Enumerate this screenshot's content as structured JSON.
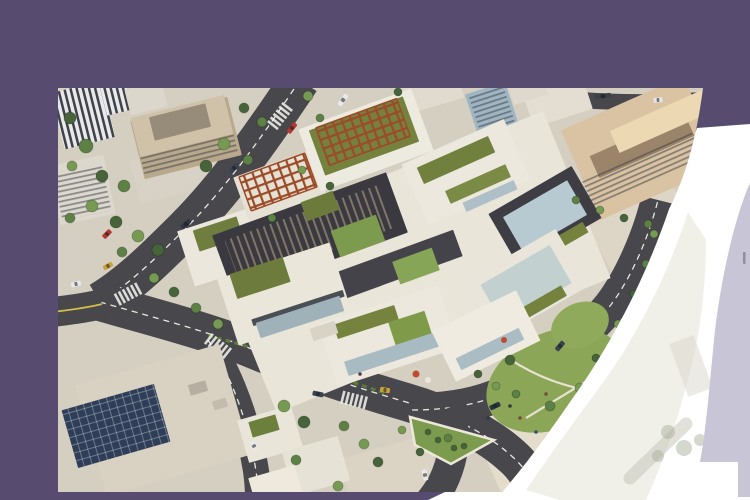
{
  "meta": {
    "description": "Hero banner: aerial architectural rendering of a mixed-use development with green roofs, framed by a purple backdrop with a large white curved cutout, a faint ghost band of the image and a lavender arc strip at the right edge",
    "visible_text": []
  },
  "palette": {
    "purple": "#574b70",
    "lavender": "#c8c5d6",
    "white": "#ffffff",
    "ground": "#d5cfc2",
    "asphalt": "#47474c",
    "lane_dash": "#e8e8e0",
    "lane_yellow": "#d2bf4a",
    "complex_white": "#ece8dd",
    "green_roof": "#74823e",
    "lawn": "#8aa656",
    "pergola_rust": "#9c4a28",
    "dark_structure": "#3a393f",
    "glass": "#b7cad2",
    "hotel_tan": "#d9c3a2",
    "solar_navy": "#2f3e58",
    "tree_colors": [
      "#46633a",
      "#5d8045",
      "#769a52"
    ],
    "people_colors": [
      "#2f3a44",
      "#7a4a3a",
      "#36506a",
      "#503a50"
    ]
  },
  "scene": {
    "photo_box": {
      "left": 58,
      "top": 88,
      "width": 647,
      "height": 404
    },
    "patches": [
      [
        "parking-lot-topleft",
        118,
        84,
        84,
        44,
        -14,
        "#d8d2c6"
      ],
      [
        "plaza-right",
        492,
        330,
        150,
        95,
        -24,
        "#e4ddcc"
      ],
      [
        "plaza-upper-right",
        600,
        168,
        95,
        125,
        -30,
        "#ddd6c6"
      ],
      [
        "lot-bottom",
        332,
        386,
        92,
        56,
        -16,
        "#dbd4c5"
      ]
    ],
    "roads": [
      {
        "n": "back-road",
        "d": "M242,-8 C210,40 170,98 128,140 C100,168 72,196 42,214",
        "w": 40,
        "center": "dash"
      },
      {
        "n": "front-road",
        "d": "M42,214 C90,228 150,243 196,262 C250,284 300,300 348,314 C392,327 430,345 458,372 C470,384 476,396 478,408",
        "w": 38,
        "center": "dash"
      },
      {
        "n": "sweep-road",
        "d": "M354,322 C396,322 434,314 462,296 C498,272 528,248 552,218 C572,192 590,152 600,112",
        "w": 34,
        "center": "dash"
      },
      {
        "n": "down-road",
        "d": "M150,252 C170,282 184,320 192,352 C198,380 200,392 200,410",
        "w": 26,
        "center": "dash"
      },
      {
        "n": "yellow-road",
        "d": "M44,216 C28,220 12,222 -6,224",
        "w": 30,
        "center": "yellow"
      },
      {
        "n": "front-road-exit",
        "d": "M390,320 C400,344 396,372 384,396 C378,406 372,414 366,420",
        "w": 30
      },
      {
        "n": "top-right-street",
        "d": "M480,8 C530,14 580,16 646,12",
        "w": 16
      }
    ],
    "greens": [
      {
        "type": "ellipse",
        "n": "lawn-main",
        "cx": 497,
        "cy": 292,
        "rx": 72,
        "ry": 48,
        "rot": -24,
        "f": "#8aa656"
      },
      {
        "type": "ellipse",
        "n": "lawn-upper",
        "cx": 522,
        "cy": 237,
        "rx": 30,
        "ry": 22,
        "rot": -24,
        "f": "#90aa5c"
      },
      {
        "type": "path",
        "n": "lawn-path",
        "d": "M450,270 C480,290 510,300 545,305",
        "s": "#e8e2d2",
        "sw": 2.2
      },
      {
        "type": "path",
        "n": "lawn-path",
        "d": "M468,330 C494,314 518,300 540,286",
        "s": "#e8e2d2",
        "sw": 2.2
      },
      {
        "type": "poly",
        "n": "median-triangle",
        "pts": "352,329 436,352 393,376 357,357",
        "f": "#7d9b4e",
        "s": "#ece7d8",
        "sw": 2.5
      },
      {
        "type": "path",
        "n": "hedge-line",
        "d": "M150,248 C210,262 268,286 330,306",
        "s": "#5d7a3a",
        "sw": 3,
        "dash": "5,4"
      }
    ],
    "crosswalks": [
      [
        222,
        28,
        -52
      ],
      [
        160,
        258,
        38
      ],
      [
        296,
        312,
        14
      ],
      [
        70,
        206,
        -28
      ]
    ],
    "buildings": [
      [
        "striped-tower",
        25,
        27,
        52,
        58,
        -14,
        "url(#zebra)"
      ],
      [
        "striped-tower-small",
        58,
        10,
        26,
        30,
        -14,
        "url(#zebra)"
      ],
      [
        "white-box-top",
        88,
        10,
        38,
        26,
        -14,
        "#dcd7cd"
      ],
      [
        "office-facade",
        128,
        50,
        100,
        60,
        -14,
        "#b9a98c"
      ],
      [
        "office-window-rows",
        130,
        62,
        96,
        28,
        -14,
        "url(#rows)"
      ],
      [
        "office-roof",
        124,
        38,
        96,
        40,
        -14,
        "#cfc2a9"
      ],
      [
        "office-roof-core",
        122,
        34,
        58,
        24,
        -14,
        "#978b7a"
      ],
      [
        "slab-left",
        24,
        102,
        56,
        60,
        -12,
        "#ddd8ce"
      ],
      [
        "slab-left-rows",
        24,
        104,
        50,
        48,
        -12,
        "url(#rows)"
      ],
      [
        "low-block-left",
        14,
        162,
        40,
        42,
        -12,
        "#d5cfc3"
      ],
      [
        "solar-roof-building",
        105,
        332,
        150,
        115,
        -16,
        "#d9d1c1"
      ],
      [
        "solar-panels",
        58,
        338,
        96,
        60,
        -16,
        "#2f3e58"
      ],
      [
        "solar-panel-grid",
        58,
        338,
        96,
        60,
        -16,
        "url(#grid)"
      ],
      [
        "rooftop-unit",
        140,
        300,
        18,
        11,
        -16,
        "#b5aea1"
      ],
      [
        "rooftop-unit",
        162,
        316,
        14,
        9,
        -16,
        "#c2bbae"
      ],
      [
        "res-block",
        212,
        346,
        56,
        44,
        -16,
        "#eae5d9"
      ],
      [
        "res-green-roof",
        206,
        338,
        28,
        16,
        -16,
        "#6c7f3d"
      ],
      [
        "res-block",
        258,
        378,
        58,
        46,
        -16,
        "#e7e2d6"
      ],
      [
        "res-block",
        218,
        400,
        48,
        34,
        -16,
        "#efe9dd"
      ],
      [
        "hotel-base",
        584,
        60,
        134,
        98,
        -24,
        "#d9c3a2"
      ],
      [
        "hotel-courtyard",
        584,
        58,
        104,
        24,
        -24,
        "#9b8469"
      ],
      [
        "hotel-window-rows",
        584,
        80,
        120,
        30,
        -24,
        "url(#rows)"
      ],
      [
        "hotel-roof-lit",
        606,
        32,
        108,
        24,
        -24,
        "#ecd8b2"
      ],
      [
        "glass-tower",
        434,
        22,
        42,
        46,
        -18,
        "#9fb6c2"
      ],
      [
        "glass-tower-rows",
        434,
        22,
        36,
        40,
        -18,
        "url(#rows)"
      ],
      [
        "white-top-building",
        500,
        14,
        62,
        34,
        -18,
        "#e4ded2"
      ],
      [
        "white-top-building",
        372,
        6,
        64,
        26,
        -16,
        "#e1dbcf"
      ],
      [
        "white-top-building",
        470,
        2,
        36,
        20,
        -18,
        "#dfd9cd"
      ],
      [
        "complex-podium",
        352,
        174,
        360,
        180,
        -22,
        "#e9e5d9"
      ],
      [
        "block-left-tip",
        168,
        158,
        84,
        58,
        -18,
        "#ebe7dc"
      ],
      [
        "block-left-green",
        160,
        146,
        46,
        22,
        -18,
        "#6f7e3e"
      ],
      [
        "pergola-terrace",
        222,
        98,
        82,
        48,
        -20,
        "#e5e1d4"
      ],
      [
        "pergola-grid",
        220,
        94,
        70,
        36,
        -20,
        "url(#pergola)",
        "#9c4a28",
        1.5
      ],
      [
        "block-a-white",
        308,
        52,
        120,
        66,
        -20,
        "#edeae0"
      ],
      [
        "block-a-green",
        306,
        48,
        100,
        48,
        -20,
        "#74823e"
      ],
      [
        "pergola-grid",
        305,
        44,
        86,
        40,
        -20,
        "url(#pergola)",
        "#9c4a28",
        1.5
      ],
      [
        "block-b-white",
        408,
        84,
        112,
        66,
        -24,
        "#ece8dd"
      ],
      [
        "block-b-green",
        398,
        72,
        78,
        18,
        -24,
        "#72803e"
      ],
      [
        "block-b-green",
        420,
        96,
        66,
        14,
        -24,
        "#7b8a45"
      ],
      [
        "block-b-glass",
        432,
        108,
        56,
        10,
        -24,
        "#aebfc7"
      ],
      [
        "dark-roof-structure",
        252,
        146,
        185,
        64,
        -20,
        "#3a393f"
      ],
      [
        "dark-roof-slats",
        252,
        146,
        165,
        46,
        -20,
        "url(#slats)"
      ],
      [
        "dark-beam",
        320,
        184,
        170,
        28,
        -20,
        "#44434a"
      ],
      [
        "block-c-frame",
        487,
        128,
        96,
        60,
        -30,
        "#3e3d44"
      ],
      [
        "block-c-glass",
        487,
        128,
        74,
        40,
        -30,
        "#b7cad2"
      ],
      [
        "block-c-green",
        505,
        152,
        52,
        12,
        -30,
        "#74823e"
      ],
      [
        "block-d-frame",
        468,
        196,
        106,
        66,
        -30,
        "#e9e5da"
      ],
      [
        "block-d-glass",
        468,
        196,
        80,
        44,
        -30,
        "#c2d1cf"
      ],
      [
        "block-d-green",
        486,
        214,
        46,
        12,
        -30,
        "#74823e"
      ],
      [
        "block-e-white",
        226,
        206,
        118,
        70,
        -18,
        "#eae6da"
      ],
      [
        "block-e-green",
        202,
        190,
        56,
        26,
        -18,
        "#6d7c3c"
      ],
      [
        "block-e-darkband",
        240,
        220,
        96,
        7,
        -18,
        "#4a4f55"
      ],
      [
        "block-e-glass",
        242,
        229,
        88,
        16,
        -18,
        "#9fb2ba"
      ],
      [
        "block-f-white",
        330,
        248,
        126,
        66,
        -18,
        "#ece8dd"
      ],
      [
        "block-f-greenroof",
        308,
        234,
        64,
        15,
        -18,
        "#75833f"
      ],
      [
        "block-f-courtyard",
        352,
        240,
        38,
        24,
        -18,
        "#7f9b4a"
      ],
      [
        "block-f-glass",
        334,
        266,
        96,
        15,
        -18,
        "#a8bac2"
      ],
      [
        "block-g-white",
        428,
        248,
        94,
        56,
        -26,
        "#efebe0"
      ],
      [
        "block-g-glass",
        432,
        261,
        70,
        13,
        -26,
        "#aabcc4"
      ],
      [
        "courtyard-green",
        300,
        148,
        48,
        28,
        -20,
        "#7d9b4e"
      ],
      [
        "courtyard-green",
        358,
        178,
        42,
        24,
        -20,
        "#87a556"
      ],
      [
        "courtyard-green",
        262,
        118,
        34,
        20,
        -20,
        "#6c7b3b"
      ],
      [
        "entrance-stair",
        266,
        243,
        26,
        13,
        -18,
        "#d9d3c5"
      ]
    ],
    "trees": [
      [
        12,
        30,
        6
      ],
      [
        28,
        58,
        7
      ],
      [
        14,
        78,
        5
      ],
      [
        44,
        88,
        6
      ],
      [
        66,
        98,
        6
      ],
      [
        34,
        118,
        6
      ],
      [
        58,
        134,
        6
      ],
      [
        12,
        130,
        5
      ],
      [
        80,
        148,
        6
      ],
      [
        100,
        162,
        6
      ],
      [
        64,
        164,
        5
      ],
      [
        96,
        190,
        5
      ],
      [
        116,
        204,
        5
      ],
      [
        138,
        220,
        5
      ],
      [
        160,
        236,
        5
      ],
      [
        186,
        20,
        5
      ],
      [
        204,
        34,
        5
      ],
      [
        166,
        56,
        6
      ],
      [
        148,
        78,
        6
      ],
      [
        190,
        72,
        5
      ],
      [
        250,
        8,
        5
      ],
      [
        340,
        4,
        4
      ],
      [
        262,
        30,
        4
      ],
      [
        244,
        82,
        4
      ],
      [
        272,
        98,
        4
      ],
      [
        214,
        130,
        4
      ],
      [
        226,
        318,
        6
      ],
      [
        246,
        334,
        6
      ],
      [
        286,
        338,
        5
      ],
      [
        306,
        356,
        5
      ],
      [
        320,
        374,
        5
      ],
      [
        238,
        372,
        5
      ],
      [
        280,
        398,
        5
      ],
      [
        362,
        364,
        4
      ],
      [
        390,
        350,
        4
      ],
      [
        344,
        342,
        4
      ],
      [
        452,
        272,
        5
      ],
      [
        492,
        318,
        5
      ],
      [
        522,
        300,
        5
      ],
      [
        538,
        270,
        4
      ],
      [
        458,
        306,
        4
      ],
      [
        438,
        298,
        4
      ],
      [
        420,
        286,
        4
      ],
      [
        508,
        332,
        4
      ],
      [
        560,
        236,
        4
      ],
      [
        576,
        206,
        4
      ],
      [
        588,
        176,
        4
      ],
      [
        596,
        146,
        4
      ],
      [
        566,
        262,
        4
      ],
      [
        518,
        112,
        4
      ],
      [
        542,
        122,
        4
      ],
      [
        566,
        130,
        4
      ],
      [
        590,
        136,
        4
      ],
      [
        380,
        352,
        3,
        0
      ],
      [
        396,
        360,
        3,
        0
      ],
      [
        370,
        344,
        3,
        0
      ],
      [
        406,
        358,
        3,
        0
      ]
    ],
    "cars": [
      [
        234,
        40,
        -52,
        "#b23a32",
        12
      ],
      [
        176,
        80,
        -48,
        "#3a4150",
        11
      ],
      [
        285,
        12,
        -55,
        "#e9e9ea",
        13
      ],
      [
        128,
        136,
        -44,
        "#2e3440",
        11
      ],
      [
        49,
        146,
        -45,
        "#b23a32",
        10
      ],
      [
        50,
        178,
        -28,
        "#c9a23c",
        10
      ],
      [
        18,
        196,
        -16,
        "#e9e9ea",
        10
      ],
      [
        260,
        306,
        12,
        "#3a4150",
        11
      ],
      [
        327,
        302,
        10,
        "#c9a23c",
        10
      ],
      [
        367,
        387,
        78,
        "#e9e9ea",
        11
      ],
      [
        437,
        318,
        -25,
        "#2b3140",
        11
      ],
      [
        502,
        258,
        -50,
        "#3a4150",
        11
      ],
      [
        557,
        251,
        -56,
        "#dcdcde",
        12
      ],
      [
        196,
        358,
        62,
        "#e9e9ea",
        10
      ],
      [
        545,
        8,
        -6,
        "#3a4148",
        16
      ],
      [
        600,
        12,
        -6,
        "#e6e6e6",
        9
      ]
    ],
    "people": [
      [
        452,
        318
      ],
      [
        462,
        330
      ],
      [
        478,
        344
      ],
      [
        500,
        352
      ],
      [
        430,
        330
      ],
      [
        488,
        306
      ],
      [
        340,
        296
      ],
      [
        302,
        286
      ],
      [
        522,
        344
      ],
      [
        556,
        302
      ]
    ],
    "details": [
      {
        "n": "cafe-umbrella",
        "cx": 358,
        "cy": 286,
        "r": 3.5,
        "f": "#c14a33"
      },
      {
        "n": "cafe-umbrella",
        "cx": 370,
        "cy": 292,
        "r": 3,
        "f": "#eae6dc"
      },
      {
        "n": "cafe-umbrella",
        "cx": 446,
        "cy": 252,
        "r": 3,
        "f": "#c14a33"
      }
    ]
  }
}
